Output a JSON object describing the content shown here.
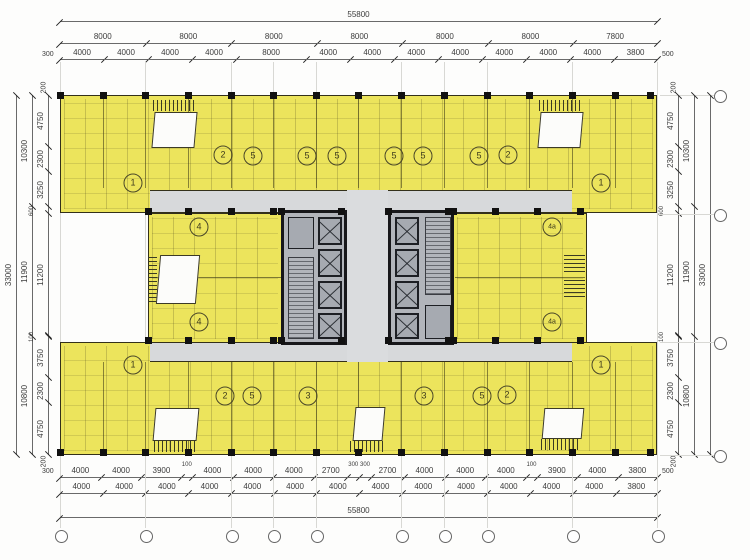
{
  "colors": {
    "yellow": "#ece45c",
    "wall": "#33301a",
    "corridor": "#d7d9db",
    "core": "#b2b5bb",
    "shaft": "#a6aab1",
    "dim": "#3c3c3c",
    "lightwell": "#fcfcfa"
  },
  "dims": {
    "top_total": [
      {
        "v": 55800,
        "l": "55800"
      }
    ],
    "top_row2": [
      {
        "v": 8000,
        "l": "8000"
      },
      {
        "v": 8000,
        "l": "8000"
      },
      {
        "v": 8000,
        "l": "8000"
      },
      {
        "v": 8000,
        "l": "8000"
      },
      {
        "v": 8000,
        "l": "8000"
      },
      {
        "v": 8000,
        "l": "8000"
      },
      {
        "v": 7800,
        "l": "7800"
      }
    ],
    "top_row3": [
      {
        "v": 4000,
        "l": "4000"
      },
      {
        "v": 4000,
        "l": "4000"
      },
      {
        "v": 4000,
        "l": "4000"
      },
      {
        "v": 4000,
        "l": "4000"
      },
      {
        "v": 8000,
        "l": "8000"
      },
      {
        "v": 4000,
        "l": "4000"
      },
      {
        "v": 4000,
        "l": "4000"
      },
      {
        "v": 4000,
        "l": "4000"
      },
      {
        "v": 4000,
        "l": "4000"
      },
      {
        "v": 4000,
        "l": "4000"
      },
      {
        "v": 4000,
        "l": "4000"
      },
      {
        "v": 4000,
        "l": "4000"
      },
      {
        "v": 3800,
        "l": "3800"
      }
    ],
    "top_left_end": "300",
    "top_right_end": "500",
    "bottom_row1": [
      {
        "v": 4000,
        "l": "4000"
      },
      {
        "v": 4000,
        "l": "4000"
      },
      {
        "v": 3900,
        "l": "3900"
      },
      {
        "v": 100,
        "l": "100",
        "s": true
      },
      {
        "v": 4000,
        "l": "4000"
      },
      {
        "v": 4000,
        "l": "4000"
      },
      {
        "v": 4000,
        "l": "4000"
      },
      {
        "v": 2700,
        "l": "2700"
      },
      {
        "v": 300,
        "l": "300",
        "s": true
      },
      {
        "v": 300,
        "l": "300",
        "s": true
      },
      {
        "v": 2700,
        "l": "2700"
      },
      {
        "v": 4000,
        "l": "4000"
      },
      {
        "v": 4000,
        "l": "4000"
      },
      {
        "v": 4000,
        "l": "4000"
      },
      {
        "v": 100,
        "l": "100",
        "s": true
      },
      {
        "v": 3900,
        "l": "3900"
      },
      {
        "v": 4000,
        "l": "4000"
      },
      {
        "v": 3800,
        "l": "3800"
      }
    ],
    "bottom_left_end": "300",
    "bottom_right_end": "500",
    "bottom_row2": [
      {
        "v": 4000,
        "l": "4000"
      },
      {
        "v": 4000,
        "l": "4000"
      },
      {
        "v": 4000,
        "l": "4000"
      },
      {
        "v": 4000,
        "l": "4000"
      },
      {
        "v": 4000,
        "l": "4000"
      },
      {
        "v": 4000,
        "l": "4000"
      },
      {
        "v": 4000,
        "l": "4000"
      },
      {
        "v": 4000,
        "l": "4000"
      },
      {
        "v": 4000,
        "l": "4000"
      },
      {
        "v": 4000,
        "l": "4000"
      },
      {
        "v": 4000,
        "l": "4000"
      },
      {
        "v": 4000,
        "l": "4000"
      },
      {
        "v": 4000,
        "l": "4000"
      },
      {
        "v": 3800,
        "l": "3800"
      }
    ],
    "bottom_total": [
      {
        "v": 55800,
        "l": "55800"
      }
    ],
    "left_outer": [
      {
        "v": 33000,
        "l": "33000"
      }
    ],
    "left_mid": [
      {
        "v": 10300,
        "l": "10300"
      },
      {
        "v": 11900,
        "l": "11900"
      },
      {
        "v": 10800,
        "l": "10800"
      }
    ],
    "left_inner": [
      {
        "v": 4750,
        "l": "4750"
      },
      {
        "v": 2300,
        "l": "2300"
      },
      {
        "v": 3250,
        "l": "3250"
      },
      {
        "v": 600,
        "l": "600",
        "s": true
      },
      {
        "v": 11200,
        "l": "11200"
      },
      {
        "v": 100,
        "l": "100",
        "s": true
      },
      {
        "v": 3750,
        "l": "3750"
      },
      {
        "v": 2300,
        "l": "2300"
      },
      {
        "v": 4750,
        "l": "4750"
      }
    ],
    "left_top_end": "200",
    "left_bottom_end": "200",
    "right_inner": [
      {
        "v": 4750,
        "l": "4750"
      },
      {
        "v": 2300,
        "l": "2300"
      },
      {
        "v": 3250,
        "l": "3250"
      },
      {
        "v": 600,
        "l": "600",
        "s": true
      },
      {
        "v": 11200,
        "l": "11200"
      },
      {
        "v": 100,
        "l": "100",
        "s": true
      },
      {
        "v": 3750,
        "l": "3750"
      },
      {
        "v": 2300,
        "l": "2300"
      },
      {
        "v": 4750,
        "l": "4750"
      }
    ],
    "right_mid": [
      {
        "v": 10300,
        "l": "10300"
      },
      {
        "v": 11900,
        "l": "11900"
      },
      {
        "v": 10800,
        "l": "10800"
      }
    ],
    "right_outer": [
      {
        "v": 33000,
        "l": "33000"
      }
    ],
    "right_top_end": "200",
    "right_bottom_end": "200"
  },
  "grid": {
    "bottom_x": [
      60,
      145,
      231,
      273,
      316,
      401,
      444,
      487,
      572,
      657
    ],
    "right_y": [
      95,
      214,
      342,
      455
    ]
  },
  "unit_labels": [
    {
      "x": 133,
      "y": 183,
      "t": "1"
    },
    {
      "x": 223,
      "y": 155,
      "t": "2"
    },
    {
      "x": 253,
      "y": 156,
      "t": "5"
    },
    {
      "x": 307,
      "y": 156,
      "t": "5"
    },
    {
      "x": 337,
      "y": 156,
      "t": "5"
    },
    {
      "x": 394,
      "y": 156,
      "t": "5"
    },
    {
      "x": 423,
      "y": 156,
      "t": "5"
    },
    {
      "x": 479,
      "y": 156,
      "t": "5"
    },
    {
      "x": 508,
      "y": 155,
      "t": "2"
    },
    {
      "x": 601,
      "y": 183,
      "t": "1"
    },
    {
      "x": 199,
      "y": 227,
      "t": "4"
    },
    {
      "x": 199,
      "y": 322,
      "t": "4"
    },
    {
      "x": 552,
      "y": 227,
      "t": "4a"
    },
    {
      "x": 552,
      "y": 322,
      "t": "4a"
    },
    {
      "x": 133,
      "y": 365,
      "t": "1"
    },
    {
      "x": 225,
      "y": 396,
      "t": "2"
    },
    {
      "x": 252,
      "y": 396,
      "t": "5"
    },
    {
      "x": 308,
      "y": 396,
      "t": "3"
    },
    {
      "x": 424,
      "y": 396,
      "t": "3"
    },
    {
      "x": 482,
      "y": 396,
      "t": "5"
    },
    {
      "x": 507,
      "y": 395,
      "t": "2"
    },
    {
      "x": 601,
      "y": 365,
      "t": "1"
    }
  ]
}
